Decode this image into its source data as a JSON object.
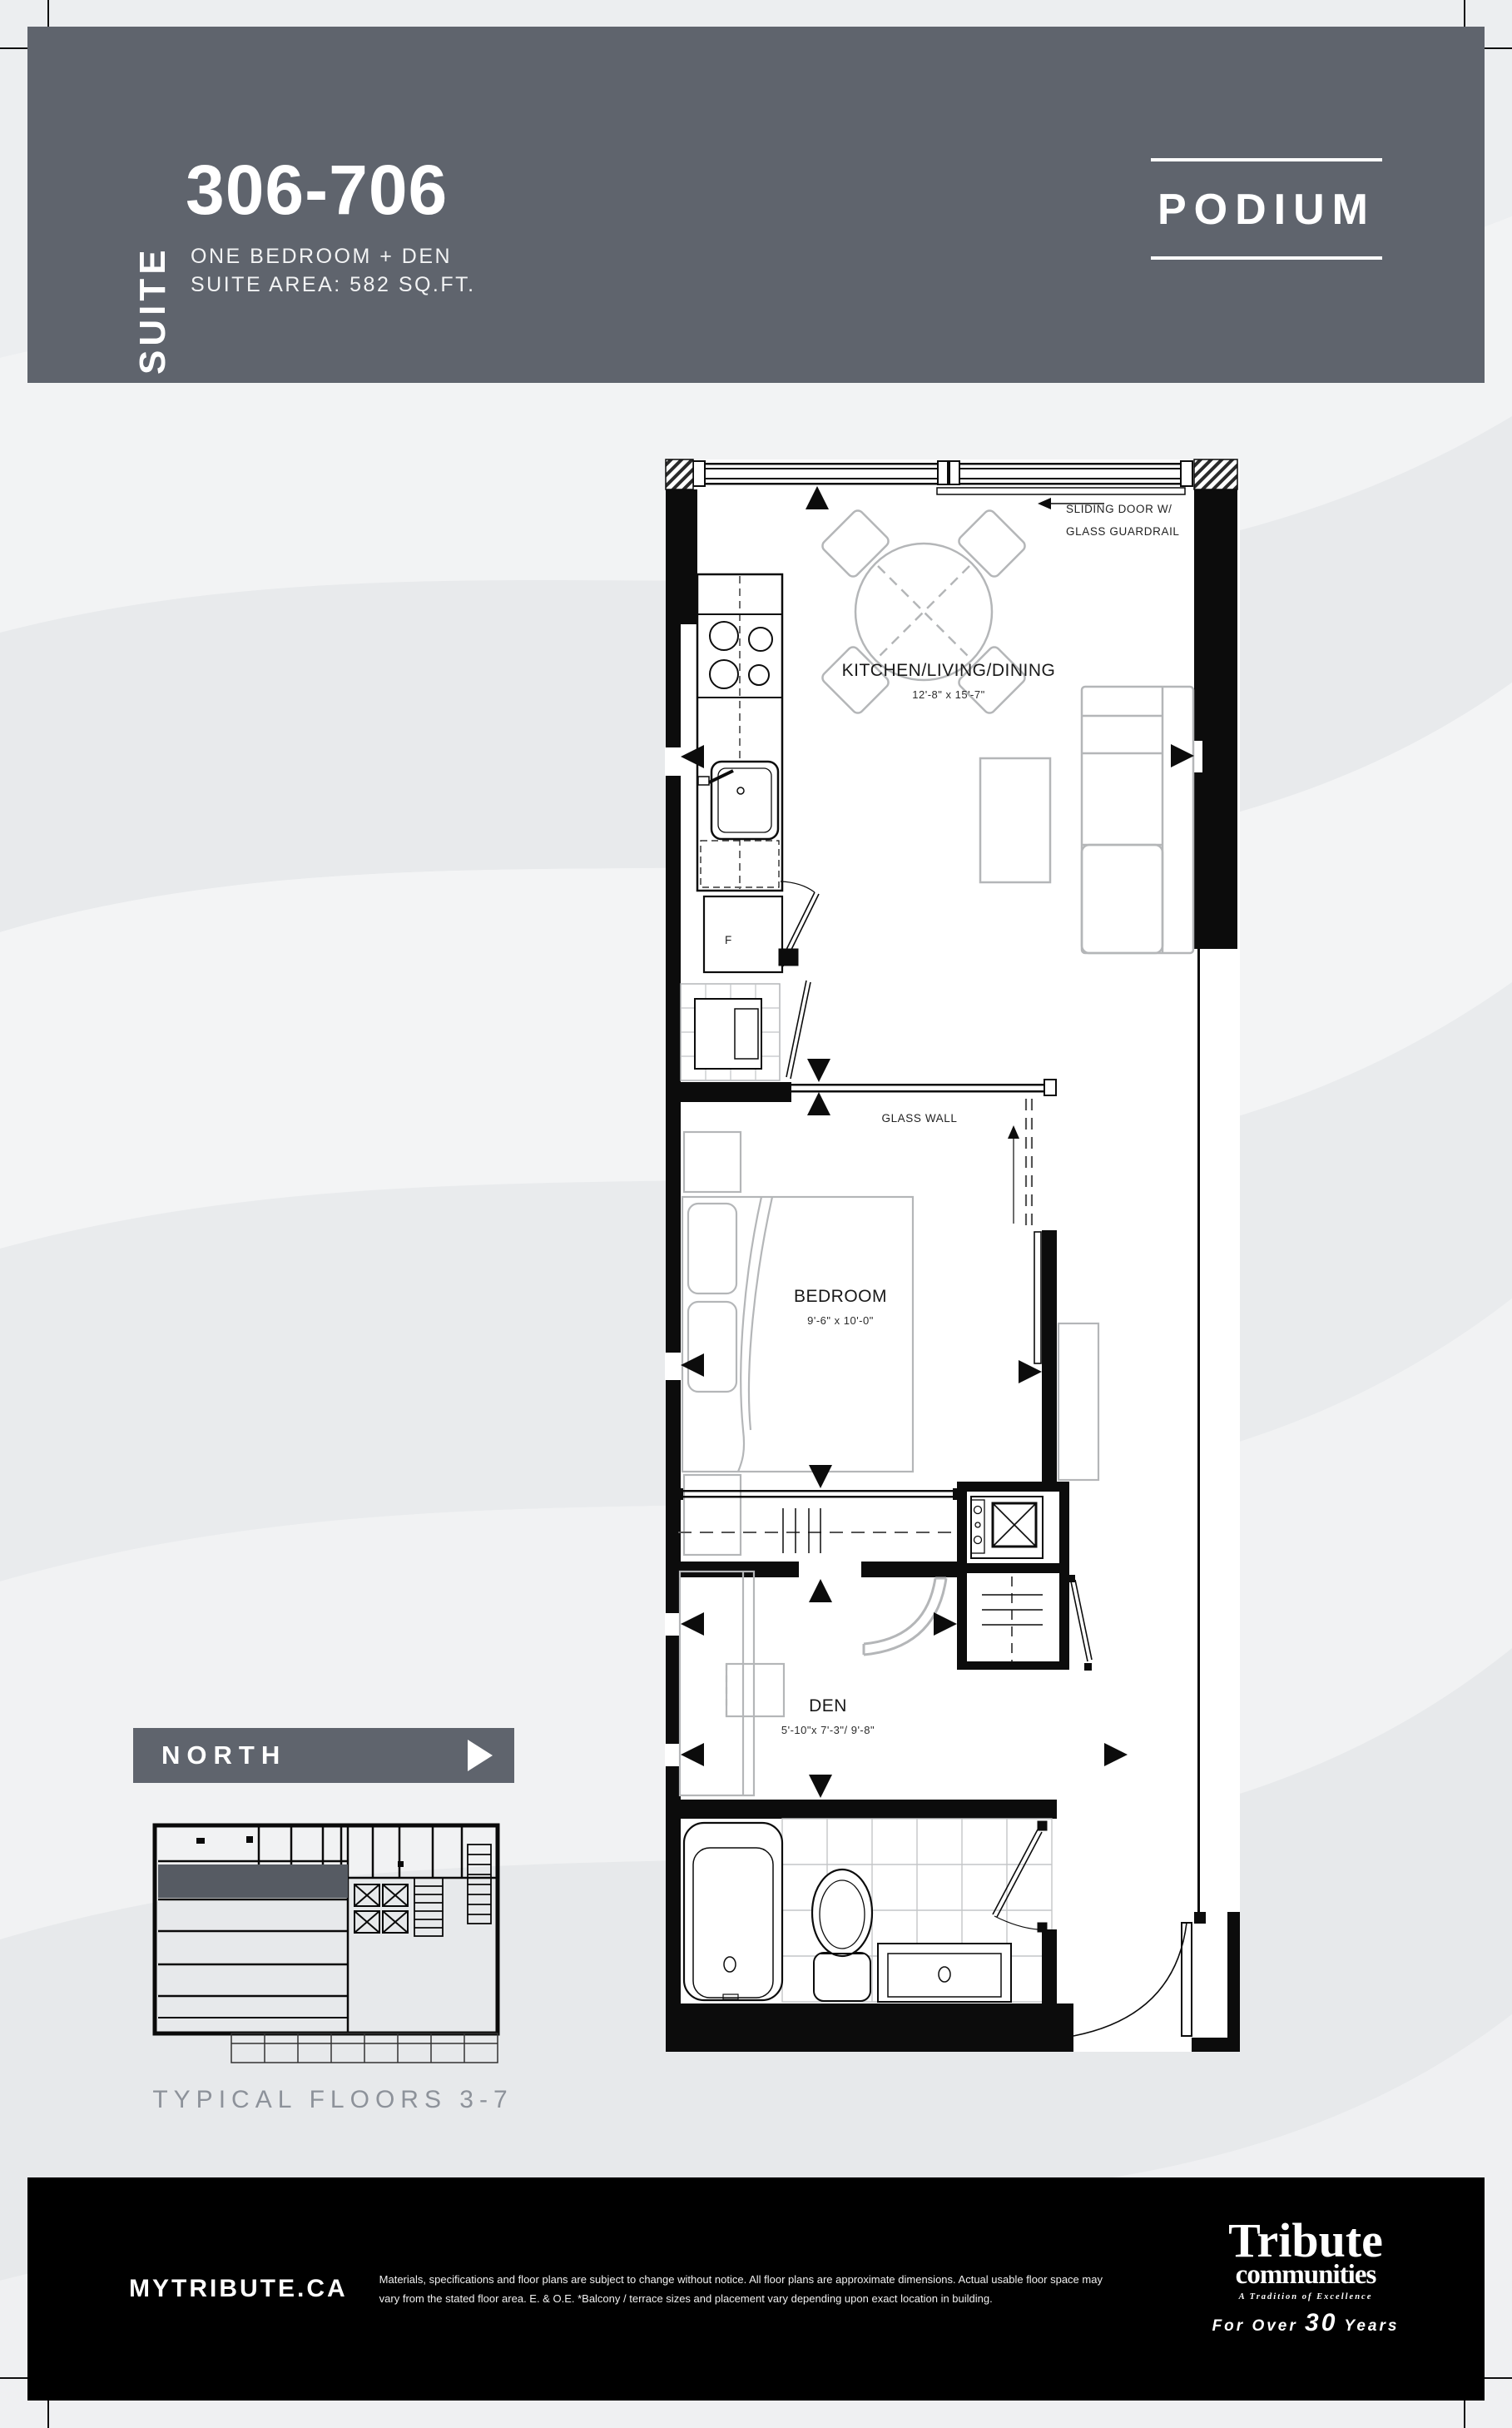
{
  "header": {
    "suite_vertical_label": "SUITE",
    "suite_number": "306-706",
    "suite_type": "ONE BEDROOM + DEN",
    "suite_area": "SUITE AREA: 582 SQ.FT.",
    "podium_label": "PODIUM"
  },
  "floor_plan": {
    "rooms": [
      {
        "name": "KITCHEN/LIVING/DINING",
        "dims": "12'-8\" x 15'-7\""
      },
      {
        "name": "BEDROOM",
        "dims": "9'-6\" x 10'-0\""
      },
      {
        "name": "DEN",
        "dims": "5'-10\"x 7'-3\"/ 9'-8\""
      }
    ],
    "labels": {
      "sliding_door_line1": "SLIDING DOOR W/",
      "sliding_door_line2": "GLASS GUARDRAIL",
      "glass_wall": "GLASS WALL",
      "fridge": "F"
    }
  },
  "key_plan": {
    "north_label": "NORTH",
    "caption": "TYPICAL FLOORS 3-7"
  },
  "footer": {
    "website": "MYTRIBUTE.CA",
    "disclaimer_line1": "Materials, specifications and floor plans are subject to change without notice. All floor plans are approximate dimensions. Actual usable floor space may",
    "disclaimer_line2": "vary from the stated floor area.  E. & O.E.  *Balcony / terrace sizes and placement vary depending upon exact location in building.",
    "logo": {
      "brand": "Tribute",
      "sub": "communities",
      "tagline": "A Tradition of Excellence",
      "years_prefix": "For Over",
      "years_number": "30",
      "years_suffix": "Years"
    }
  },
  "colors": {
    "band_slate": "#5f646d",
    "footer_black": "#000000",
    "keyplan_highlight": "#565b63",
    "caption_gray": "#8d929a"
  }
}
